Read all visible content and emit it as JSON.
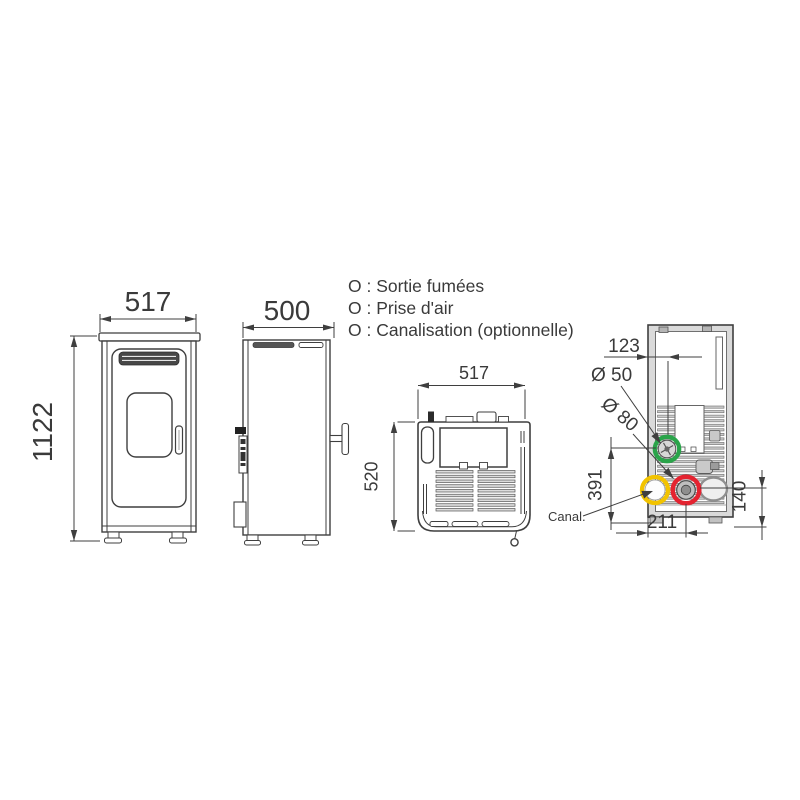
{
  "legend": {
    "items": [
      {
        "text": "O : Sortie fumées",
        "color": "#e42330"
      },
      {
        "text": "O : Prise d'air",
        "color": "#2aa44a"
      },
      {
        "text": "O : Canalisation (optionnelle)",
        "color": "#f2c300"
      }
    ]
  },
  "colors": {
    "smoke": "#e42330",
    "air": "#2aa44a",
    "duct": "#f2c300",
    "line": "#3f3f3f"
  },
  "front_view": {
    "width": "517",
    "height": "1122"
  },
  "side_view": {
    "depth": "500"
  },
  "top_view": {
    "width": "517",
    "depth": "520"
  },
  "rear_view": {
    "flue_offset_top": "123",
    "air_diameter": "Ø 50",
    "flue_diameter": "Ø 80",
    "air_height": "391",
    "flue_height": "140",
    "flue_offset": "211",
    "duct_label": "Canal."
  }
}
